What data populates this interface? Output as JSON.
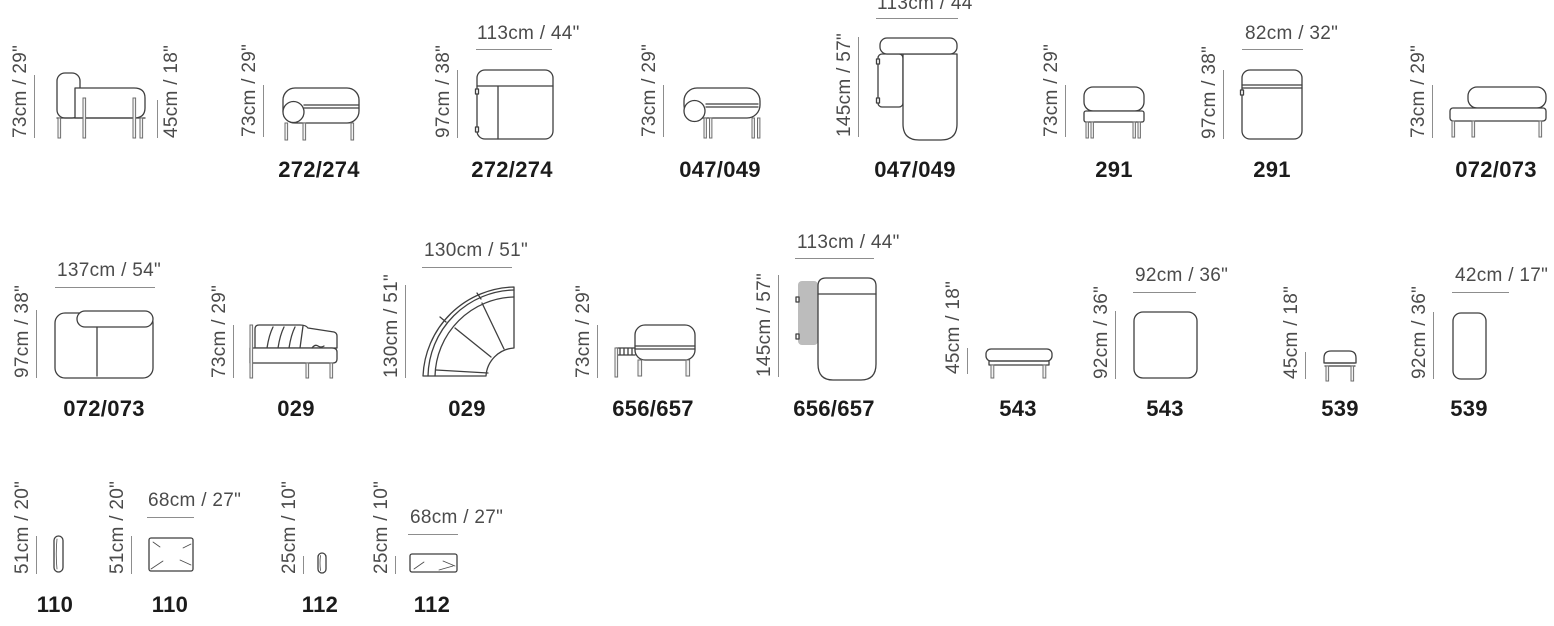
{
  "title": "Sofa modules size chart",
  "colors": {
    "line_art": "#3f3f3f",
    "dimension_line": "#8d8d8d",
    "dimension_text": "#4b4b4b",
    "model_text": "#1b1b1b",
    "shaded_table_block": "#bcbcbc",
    "background": "#ffffff"
  },
  "figures": [
    {
      "model": "",
      "dim_left": "73cm / 29\"",
      "dim_right": "45cm / 18\""
    },
    {
      "model": "272/274",
      "dim_left": "73cm / 29\""
    },
    {
      "model": "272/274",
      "dim_left": "97cm / 38\"",
      "dim_top": "113cm / 44\""
    },
    {
      "model": "047/049",
      "dim_left": "73cm / 29\""
    },
    {
      "model": "047/049",
      "dim_left": "145cm / 57\"",
      "dim_top": "113cm / 44\""
    },
    {
      "model": "291",
      "dim_left": "73cm / 29\""
    },
    {
      "model": "291",
      "dim_left": "97cm / 38\"",
      "dim_top": "82cm / 32\""
    },
    {
      "model": "072/073",
      "dim_left": "73cm / 29\""
    },
    {
      "model": "072/073",
      "dim_left": "97cm / 38\"",
      "dim_top": "137cm / 54\""
    },
    {
      "model": "029",
      "dim_left": "73cm / 29\""
    },
    {
      "model": "029",
      "dim_left": "130cm / 51\"",
      "dim_top": "130cm / 51\""
    },
    {
      "model": "656/657",
      "dim_left": "73cm / 29\""
    },
    {
      "model": "656/657",
      "dim_left": "145cm / 57\"",
      "dim_top": "113cm / 44\""
    },
    {
      "model": "543",
      "dim_left": "45cm / 18\""
    },
    {
      "model": "543",
      "dim_left": "92cm / 36\"",
      "dim_top": "92cm / 36\""
    },
    {
      "model": "539",
      "dim_left": "45cm / 18\""
    },
    {
      "model": "539",
      "dim_left": "92cm / 36\"",
      "dim_top": "42cm / 17\""
    },
    {
      "model": "110",
      "dim_left": "51cm / 20\""
    },
    {
      "model": "110",
      "dim_left": "51cm / 20\"",
      "dim_top": "68cm / 27\""
    },
    {
      "model": "112",
      "dim_left": "25cm / 10\""
    },
    {
      "model": "112",
      "dim_left": "25cm / 10\"",
      "dim_top": "68cm / 27\""
    }
  ]
}
